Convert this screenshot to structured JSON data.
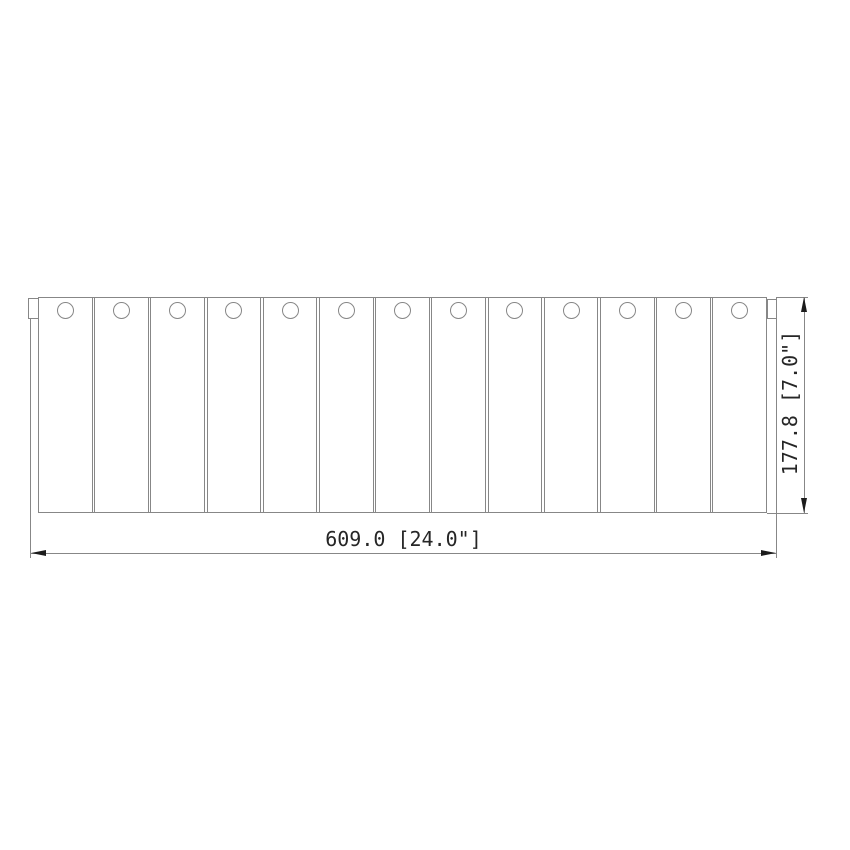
{
  "page": {
    "background": "#ffffff"
  },
  "drawing": {
    "title": "slatted-panel-front-view",
    "view": "front",
    "slat_count": 13,
    "holes_per_slat": 1,
    "dimensions": {
      "width_label": "609.0 [24.0\"]",
      "height_label": "177.8 [7.0\"]",
      "width_mm": 609.0,
      "width_in": 24.0,
      "height_mm": 177.8,
      "height_in": 7.0
    },
    "colors": {
      "object_line": "#878787",
      "dimension_line": "#878787",
      "arrow": "#1c1c1c",
      "text": "#262626",
      "background": "#ffffff"
    }
  }
}
